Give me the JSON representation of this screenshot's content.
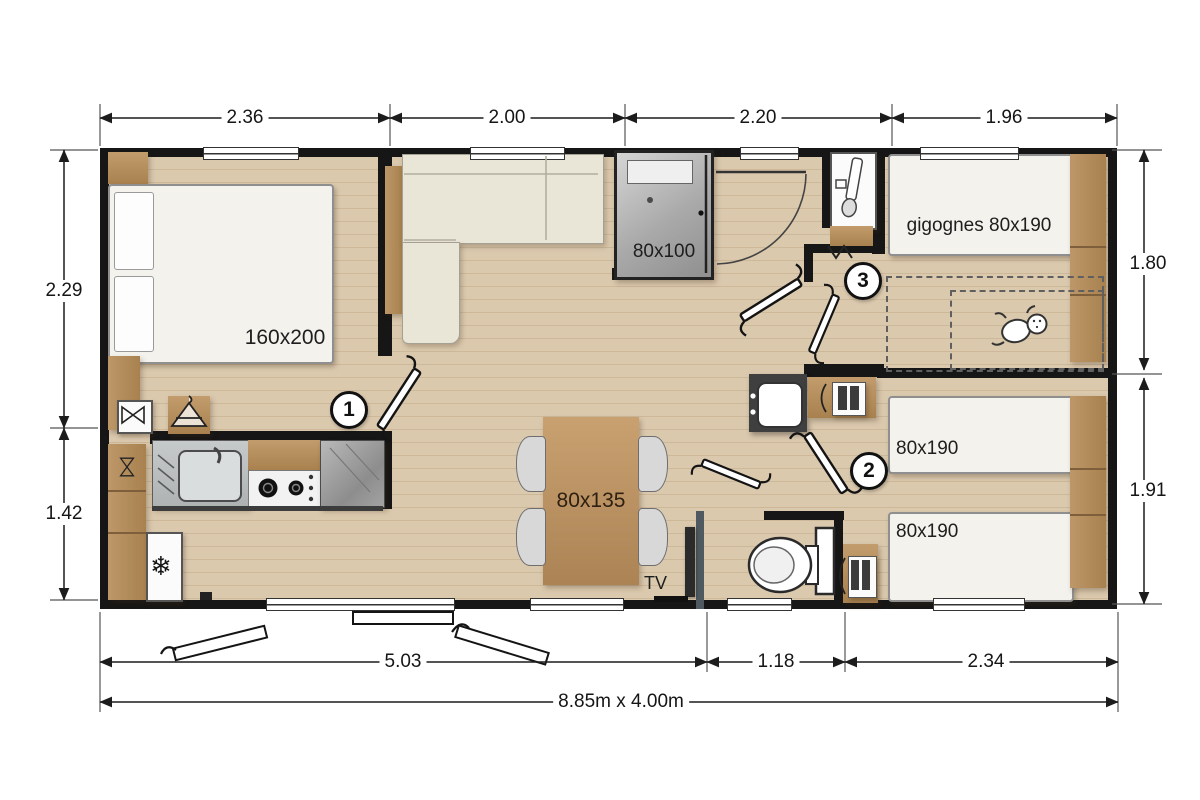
{
  "plan": {
    "overall_size": "8.85m x 4.00m",
    "dims_top": [
      "2.36",
      "2.00",
      "2.20",
      "1.96"
    ],
    "dims_left": [
      "2.29",
      "1.42"
    ],
    "dims_right": [
      "1.80",
      "1.91"
    ],
    "dims_bottom": [
      "5.03",
      "1.18",
      "2.34"
    ]
  },
  "labels": {
    "master_bed": "160x200",
    "shower": "80x100",
    "gigogne_beds": "gigognes 80x190",
    "twin_bed_top": "80x190",
    "twin_bed_bottom": "80x190",
    "dining_table": "80x135",
    "tv": "TV"
  },
  "markers": {
    "bedroom1": "1",
    "bedroom2": "2",
    "bedroom3": "3"
  },
  "icons": {
    "fridge": "❄"
  },
  "colors": {
    "wall": "#161616",
    "floor": "#dbc9ae",
    "wood": "#b08a5c",
    "mattress": "#f4f2ed",
    "sofa": "#e9e5d7",
    "counter_grey": "#9c9c9c",
    "tv_wall": "#4e5a60"
  }
}
